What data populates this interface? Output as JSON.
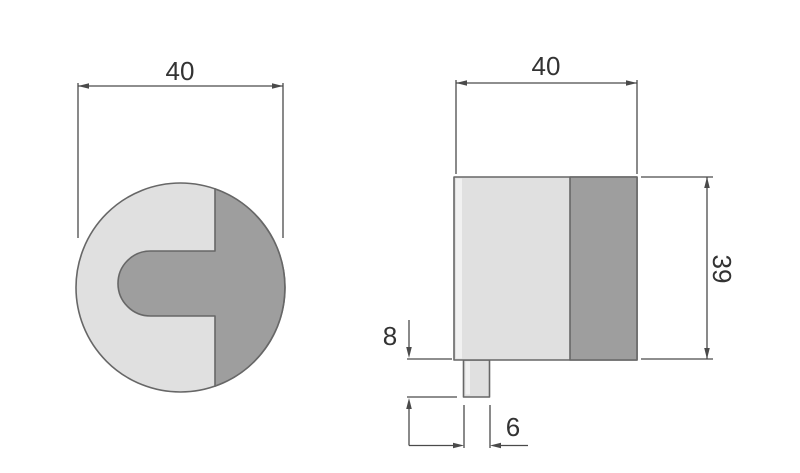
{
  "drawing": {
    "kind": "technical-dimension-drawing",
    "dimensions": {
      "front_width": "40",
      "side_width": "40",
      "side_height": "39",
      "tab_protrusion": "8",
      "tab_width": "6"
    },
    "colors": {
      "body_light": "#e0e0e0",
      "body_dark": "#9e9e9e",
      "body_highlight": "#f1f1f1",
      "outline": "#676767",
      "dimension_line": "#4a4a4a",
      "text": "#333333",
      "background": "#ffffff"
    }
  }
}
